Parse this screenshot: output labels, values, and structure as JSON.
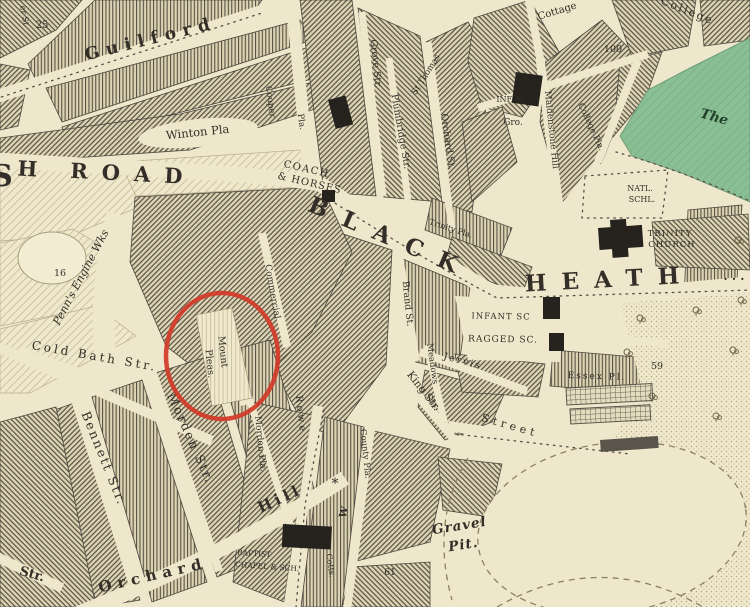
{
  "map": {
    "description": "Victorian engraved street map, Blackheath area, with red circle annotation",
    "paper_color": "#efe7cb",
    "ink_color": "#332e27",
    "block_line_color": "#57524a",
    "block_bg_color": "#ddd3b1",
    "green_area_color": "#8abf94",
    "annotation": {
      "shape": "ellipse",
      "cx": 222,
      "cy": 356,
      "rx": 56,
      "ry": 63,
      "color": "#d13a28",
      "stroke_width": 4.5
    },
    "labels": [
      {
        "t": "25",
        "x": 42,
        "y": 28,
        "s": 10
      },
      {
        "t": "Guilford",
        "x": 152,
        "y": 44,
        "r": -14,
        "s": 17,
        "ls": 7,
        "fs": "b"
      },
      {
        "t": "er St",
        "x": 22,
        "y": 16,
        "r": 80,
        "s": 8
      },
      {
        "t": "S",
        "x": 2,
        "y": 186,
        "s": 30,
        "fs": "b"
      },
      {
        "t": "H",
        "x": 27,
        "y": 176,
        "r": 3,
        "s": 21,
        "fs": "b"
      },
      {
        "t": "ROAD",
        "x": 133,
        "y": 181,
        "r": 3,
        "s": 21,
        "ls": 14,
        "fs": "b"
      },
      {
        "t": "Winton Pla",
        "x": 198,
        "y": 136,
        "r": -6,
        "s": 11.5
      },
      {
        "t": "Couper",
        "x": 268,
        "y": 102,
        "r": 82,
        "s": 8.5
      },
      {
        "t": "Pla.",
        "x": 299,
        "y": 122,
        "r": 82,
        "s": 8.5
      },
      {
        "t": "Grove Str.",
        "x": 373,
        "y": 64,
        "r": 84,
        "s": 9.5
      },
      {
        "t": "Plumbridge Str.",
        "x": 398,
        "y": 132,
        "r": 80,
        "s": 9.5
      },
      {
        "t": "Orchard St.",
        "x": 445,
        "y": 142,
        "r": 82,
        "s": 9.5
      },
      {
        "t": "St Thomas",
        "x": 428,
        "y": 76,
        "r": -58,
        "s": 8.5
      },
      {
        "t": "Cottage",
        "x": 558,
        "y": 14,
        "r": -17,
        "s": 10
      },
      {
        "t": "College",
        "x": 686,
        "y": 14,
        "r": 22,
        "s": 11,
        "ls": 2
      },
      {
        "t": "100",
        "x": 613,
        "y": 52,
        "s": 9.5
      },
      {
        "t": "INF. S.",
        "x": 510,
        "y": 102,
        "s": 8
      },
      {
        "t": "Gro.",
        "x": 513,
        "y": 125,
        "s": 9
      },
      {
        "t": "Maidenstone Hill",
        "x": 549,
        "y": 130,
        "r": 84,
        "s": 9
      },
      {
        "t": "College Pla.",
        "x": 589,
        "y": 128,
        "r": 65,
        "s": 8.5
      },
      {
        "t": "NATL.",
        "x": 640,
        "y": 191,
        "s": 8
      },
      {
        "t": "SCHL.",
        "x": 642,
        "y": 202,
        "s": 8
      },
      {
        "t": "TRINITY",
        "x": 670,
        "y": 236,
        "s": 8.5,
        "ls": 1
      },
      {
        "t": "CHURCH",
        "x": 672,
        "y": 247,
        "s": 8.5,
        "ls": 1
      },
      {
        "t": "The",
        "x": 713,
        "y": 121,
        "r": 16,
        "s": 13.5,
        "fs": "bi",
        "c": "#22402a"
      },
      {
        "t": "COACH",
        "x": 306,
        "y": 172,
        "r": 13,
        "s": 10,
        "ls": 1.5
      },
      {
        "t": "& HORSES",
        "x": 309,
        "y": 186,
        "r": 13,
        "s": 10,
        "ls": 1
      },
      {
        "t": "BLACK",
        "x": 388,
        "y": 245,
        "r": 23,
        "s": 23,
        "ls": 17,
        "fs": "b"
      },
      {
        "t": "HEATH",
        "x": 610,
        "y": 287,
        "r": -3,
        "s": 23,
        "ls": 15,
        "fs": "b"
      },
      {
        "t": ". . .",
        "x": 734,
        "y": 280,
        "s": 12,
        "fs": "b"
      },
      {
        "t": "Penn's Engine Wks",
        "x": 84,
        "y": 279,
        "r": -62,
        "s": 11,
        "fs": "i"
      },
      {
        "t": "16",
        "x": 60,
        "y": 276,
        "s": 9.5
      },
      {
        "t": "Cold Bath Str.",
        "x": 94,
        "y": 360,
        "r": 10,
        "s": 12,
        "ls": 3
      },
      {
        "t": "Mount",
        "x": 220,
        "y": 352,
        "r": 84,
        "s": 9.5
      },
      {
        "t": "Pleas.",
        "x": 207,
        "y": 364,
        "r": 84,
        "s": 9.5
      },
      {
        "t": "Commercial",
        "x": 270,
        "y": 292,
        "r": 80,
        "s": 9
      },
      {
        "t": "Brand St.",
        "x": 405,
        "y": 304,
        "r": 84,
        "s": 9.5
      },
      {
        "t": "Meadows",
        "x": 430,
        "y": 364,
        "r": 82,
        "s": 8.5
      },
      {
        "t": "Jervis",
        "x": 462,
        "y": 364,
        "r": 15,
        "s": 9.5,
        "ls": 2
      },
      {
        "t": "Trinity Pla.",
        "x": 450,
        "y": 231,
        "r": 18,
        "s": 8
      },
      {
        "t": "King Str.",
        "x": 421,
        "y": 393,
        "r": 52,
        "s": 10.5
      },
      {
        "t": "Street",
        "x": 509,
        "y": 429,
        "r": 16,
        "s": 11,
        "ls": 4
      },
      {
        "t": "INFANT SC",
        "x": 501,
        "y": 319,
        "r": 1,
        "s": 8.5,
        "ls": 1
      },
      {
        "t": "RAGGED SC.",
        "x": 503,
        "y": 342,
        "r": 1,
        "s": 9,
        "ls": 1
      },
      {
        "t": "Essex Pl.",
        "x": 597,
        "y": 379,
        "r": 2,
        "s": 9,
        "ls": 2
      },
      {
        "t": "59",
        "x": 657,
        "y": 369,
        "s": 9.5
      },
      {
        "t": "Rowe",
        "x": 298,
        "y": 415,
        "r": 84,
        "s": 9.5,
        "ls": 3
      },
      {
        "t": "County Pla.",
        "x": 363,
        "y": 454,
        "r": 84,
        "s": 8.5
      },
      {
        "t": "Cotts.",
        "x": 328,
        "y": 566,
        "r": 82,
        "s": 8
      },
      {
        "t": "Morden Pla.",
        "x": 258,
        "y": 444,
        "r": 84,
        "s": 9
      },
      {
        "t": "Bennett Str.",
        "x": 100,
        "y": 460,
        "r": 68,
        "s": 12.5,
        "ls": 2
      },
      {
        "t": "Morden Str.",
        "x": 187,
        "y": 440,
        "r": 66,
        "s": 12.5,
        "ls": 2
      },
      {
        "t": "Orchard",
        "x": 154,
        "y": 580,
        "r": -13,
        "s": 15,
        "ls": 6,
        "fs": "b"
      },
      {
        "t": "Hill",
        "x": 282,
        "y": 503,
        "r": -25,
        "s": 15,
        "ls": 4,
        "fs": "b"
      },
      {
        "t": "Str.",
        "x": 31,
        "y": 578,
        "r": 16,
        "s": 13,
        "fs": "b"
      },
      {
        "t": "BAPTIST",
        "x": 254,
        "y": 556,
        "r": 4,
        "s": 7.5
      },
      {
        "t": "CHAPEL & SCH.",
        "x": 267,
        "y": 569,
        "r": 4,
        "s": 7.5
      },
      {
        "t": "Gravel",
        "x": 460,
        "y": 530,
        "r": -9,
        "s": 13.5,
        "ls": 1,
        "fs": "bi"
      },
      {
        "t": "Pit.",
        "x": 464,
        "y": 549,
        "r": -9,
        "s": 13.5,
        "ls": 1,
        "fs": "bi"
      },
      {
        "t": "61",
        "x": 390,
        "y": 575,
        "s": 9
      },
      {
        "t": "W",
        "x": 347,
        "y": 513,
        "r": -75,
        "s": 10,
        "fs": "b"
      },
      {
        "t": "*",
        "x": 335,
        "y": 488,
        "s": 14
      }
    ]
  }
}
